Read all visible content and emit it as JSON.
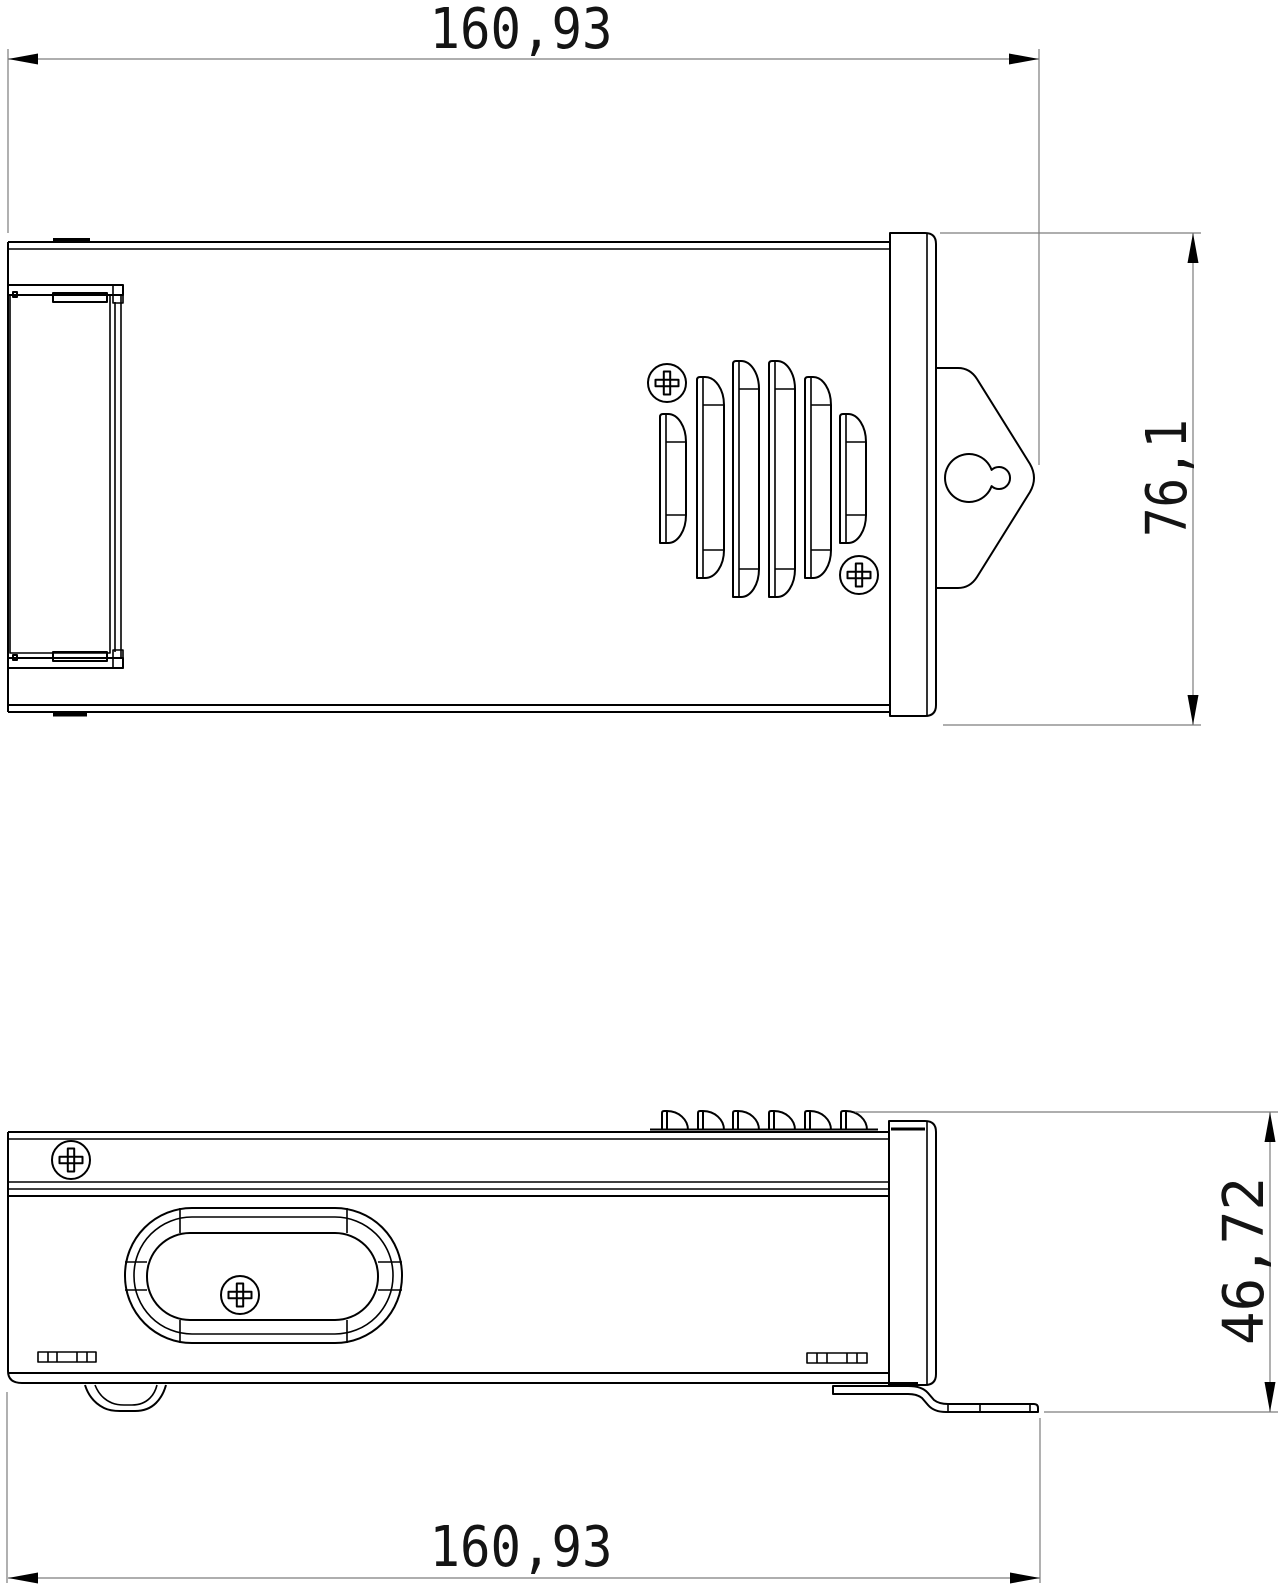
{
  "drawing": {
    "dimensions": {
      "overall_length_top": "160,93",
      "overall_height": "76,1",
      "side_height": "46,72",
      "overall_length_bottom": "160,93"
    },
    "colors": {
      "outline": "#000000",
      "dimension_lines": "#7d7d7d",
      "highlight_green": "#00d400"
    }
  }
}
